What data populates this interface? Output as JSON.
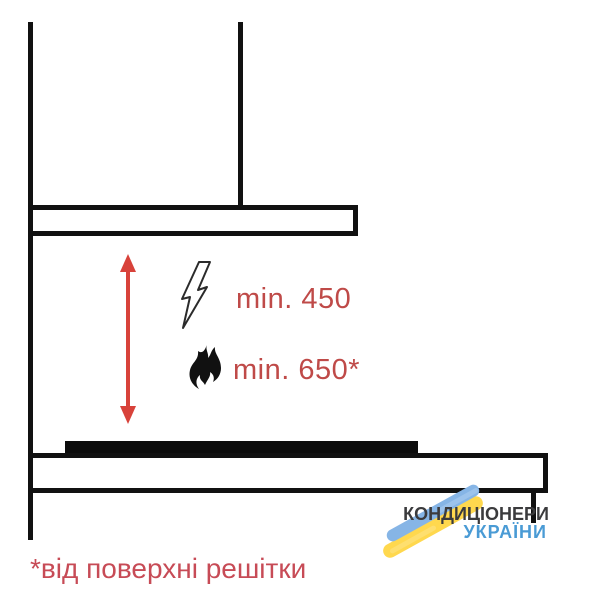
{
  "diagram": {
    "type": "cooker-hood-installation-clearance",
    "clearances": {
      "electric": {
        "label": "min. 450",
        "icon": "lightning-icon"
      },
      "gas": {
        "label": "min. 650*",
        "icon": "flame-icon"
      }
    },
    "footnote": "*від поверхні решітки",
    "icons": [
      "double-arrow-icon",
      "lightning-icon",
      "flame-icon"
    ],
    "colors": {
      "line_black": "#111111",
      "hob_black": "#0c0c0c",
      "arrow_red": "#d8423a",
      "label_red": "#bf4a48",
      "footnote_red": "#c74b56"
    }
  },
  "logo": {
    "line1": "КОНДИЦІОНЕРИ",
    "line2": "УКРАЇНИ",
    "colors": {
      "line1_text": "#3b3b3d",
      "line2_text": "#4a9bd5",
      "brush_blue": "#86b5e6",
      "brush_yellow": "#ffd84e"
    }
  }
}
